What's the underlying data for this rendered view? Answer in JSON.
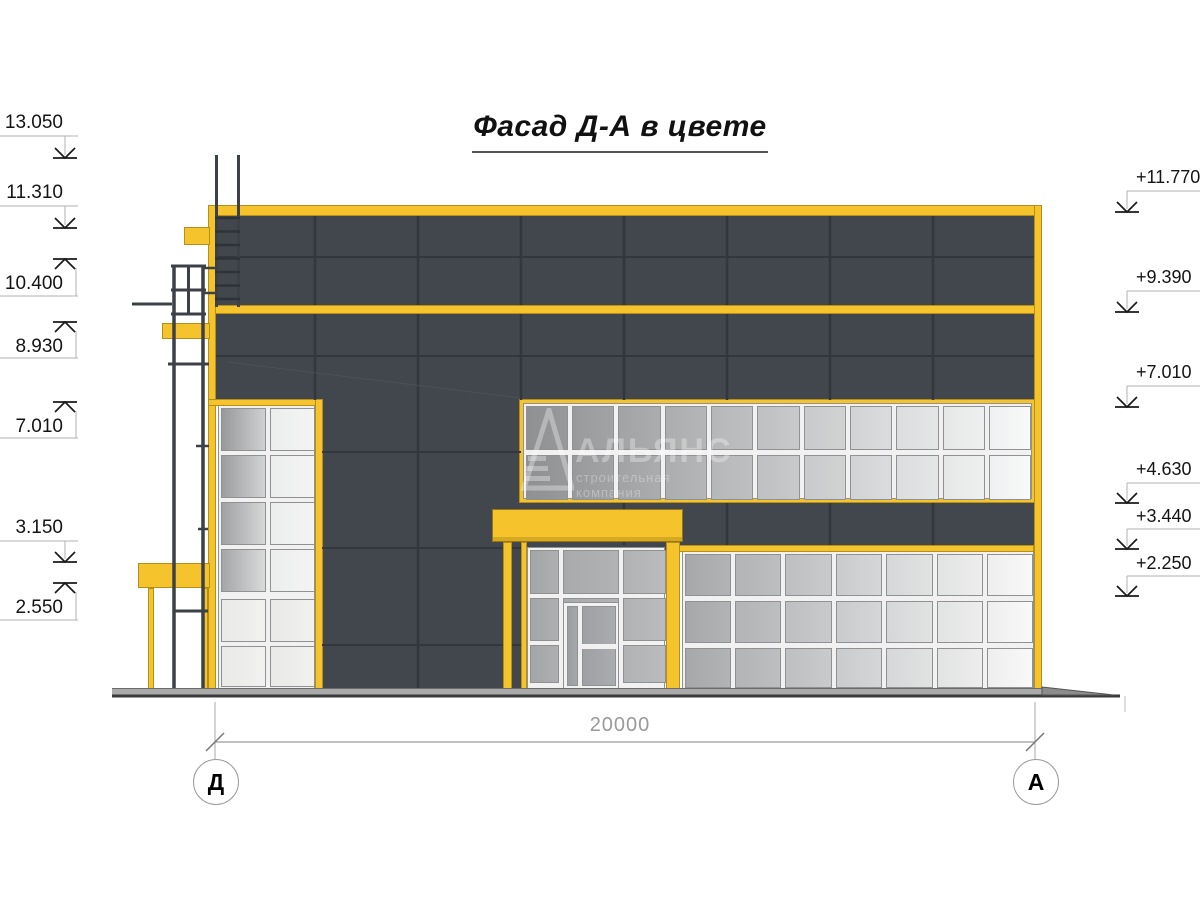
{
  "title": "Фасад Д-А в цвете",
  "watermark": {
    "brand": "АЛЬЯНС",
    "subtitle": "строительная компания",
    "logo": "triangle-pyramid-logo"
  },
  "dimension": {
    "value": "20000"
  },
  "axes": [
    {
      "label": "Д"
    },
    {
      "label": "А"
    }
  ],
  "elevation_marks": {
    "left": [
      {
        "label": "13.050",
        "arrow": "down",
        "text_y": 112,
        "line_y": 136,
        "tip_y": 158
      },
      {
        "label": "11.310",
        "arrow": "down",
        "text_y": 182,
        "line_y": 206,
        "tip_y": 228
      },
      {
        "label": "10.400",
        "arrow": "up",
        "text_y": 273,
        "line_y": 296,
        "tip_y": 259
      },
      {
        "label": "8.930",
        "arrow": "up",
        "text_y": 336,
        "line_y": 358,
        "tip_y": 322
      },
      {
        "label": "7.010",
        "arrow": "up",
        "text_y": 416,
        "line_y": 438,
        "tip_y": 402
      },
      {
        "label": "3.150",
        "arrow": "down",
        "text_y": 517,
        "line_y": 541,
        "tip_y": 562
      },
      {
        "label": "2.550",
        "arrow": "up",
        "text_y": 597,
        "line_y": 620,
        "tip_y": 583
      }
    ],
    "right": [
      {
        "label": "+11.770",
        "arrow": "down",
        "text_y": 167,
        "line_y": 191,
        "tip_y": 212
      },
      {
        "label": "+9.390",
        "arrow": "down",
        "text_y": 267,
        "line_y": 291,
        "tip_y": 312
      },
      {
        "label": "+7.010",
        "arrow": "down",
        "text_y": 362,
        "line_y": 386,
        "tip_y": 407
      },
      {
        "label": "+4.630",
        "arrow": "down",
        "text_y": 459,
        "line_y": 483,
        "tip_y": 503
      },
      {
        "label": "+3.440",
        "arrow": "down",
        "text_y": 506,
        "line_y": 529,
        "tip_y": 549
      },
      {
        "label": "+2.250",
        "arrow": "down",
        "text_y": 553,
        "line_y": 576,
        "tip_y": 596
      }
    ]
  },
  "colors": {
    "accent_yellow": "#F5C42C",
    "yellow_outline": "#9A7A12",
    "panel_dark": "#42474D",
    "panel_joint": "#32373D",
    "mullion": "#F1F1F1",
    "pane_border": "#8F9193",
    "glass_dark": "#8E9092",
    "glass_light": "#F9FAFA",
    "ladder_dark": "#3C4147",
    "ground_gray": "#A9A9A9",
    "ground_line": "#3A3A3A",
    "annotation_gray": "#9A9A9A",
    "arrow_black": "#1A1A1A",
    "text_black": "#141414"
  }
}
